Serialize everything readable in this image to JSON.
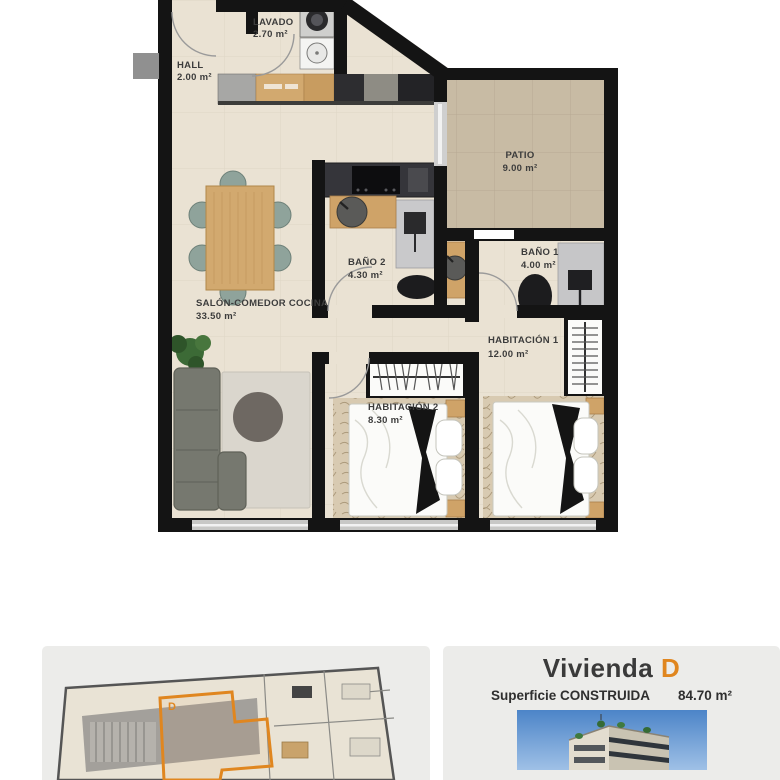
{
  "floor_plan": {
    "rooms": {
      "hall": {
        "name": "HALL",
        "area": "2.00 m²"
      },
      "lavado": {
        "name": "LAVADO",
        "area": "2.70 m²"
      },
      "patio": {
        "name": "PATIO",
        "area": "9.00 m²"
      },
      "bano2": {
        "name": "BAÑO 2",
        "area": "4.30 m²"
      },
      "bano1": {
        "name": "BAÑO 1",
        "area": "4.00 m²"
      },
      "salon": {
        "name": "SALÓN-COMEDOR COCINA",
        "area": "33.50 m²"
      },
      "hab1": {
        "name": "HABITACIÓN 1",
        "area": "12.00 m²"
      },
      "hab2": {
        "name": "HABITACIÓN 2",
        "area": "8.30 m²"
      }
    },
    "palette": {
      "wall": "#141414",
      "floor": "#eae2d3",
      "patio_floor": "#c8bba4",
      "wood": "#d2a96f",
      "accent_orange": "#e0861f"
    }
  },
  "footer": {
    "unit_title_prefix": "Vivienda",
    "unit_letter": "D",
    "surface_label": "Superficie CONSTRUIDA",
    "surface_value": "84.70 m²",
    "mini_plan_unit_label": "D"
  }
}
